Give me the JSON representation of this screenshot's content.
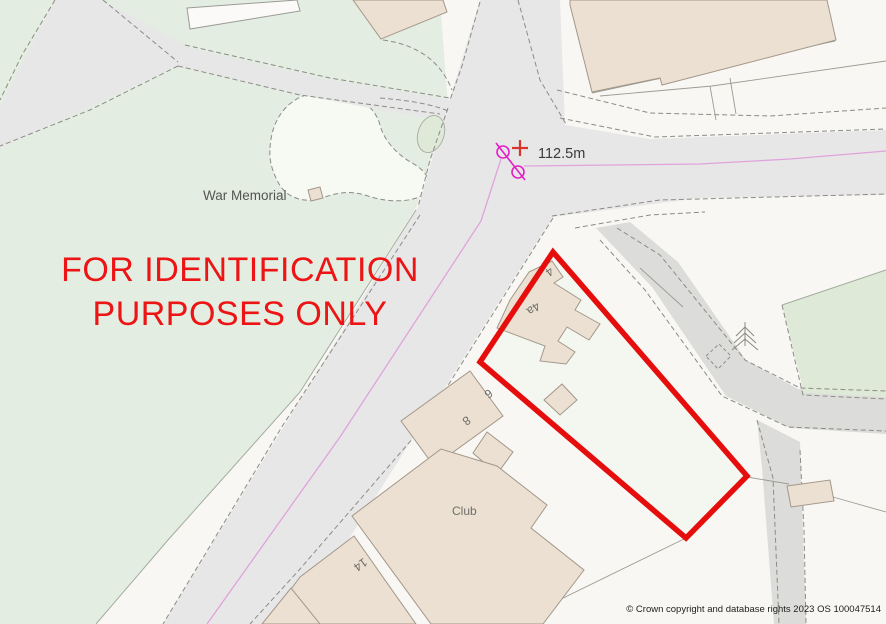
{
  "map": {
    "caption": {
      "line1": "FOR IDENTIFICATION",
      "line2": "PURPOSES ONLY",
      "color": "#ec1414"
    },
    "labels": {
      "war_memorial": "War Memorial",
      "club": "Club",
      "spot_height": "112.5m",
      "copyright": "© Crown copyright and database rights 2023 OS 100047514"
    },
    "house_numbers": [
      {
        "text": "4"
      },
      {
        "text": "4a"
      },
      {
        "text": "6"
      },
      {
        "text": "8"
      },
      {
        "text": "14"
      }
    ],
    "icons": {
      "boundary_post": "boundary-post-icon",
      "spot_cross": "spot-height-cross-icon",
      "conifer": "conifer-tree-icon"
    },
    "colors": {
      "base": "#f8f7f3",
      "greenspace": "#e4ede1",
      "greenspace_dark": "#dfe9d8",
      "road": "#e8e7e8",
      "track": "#dcdcda",
      "building": "#ebe0d1",
      "plot": "#f3f7f0",
      "boundary_red": "#e60d0d",
      "magenta_symbol": "#e320c8",
      "parish_boundary_pink": "#dfa3db",
      "cross_red": "#d8352a"
    }
  }
}
